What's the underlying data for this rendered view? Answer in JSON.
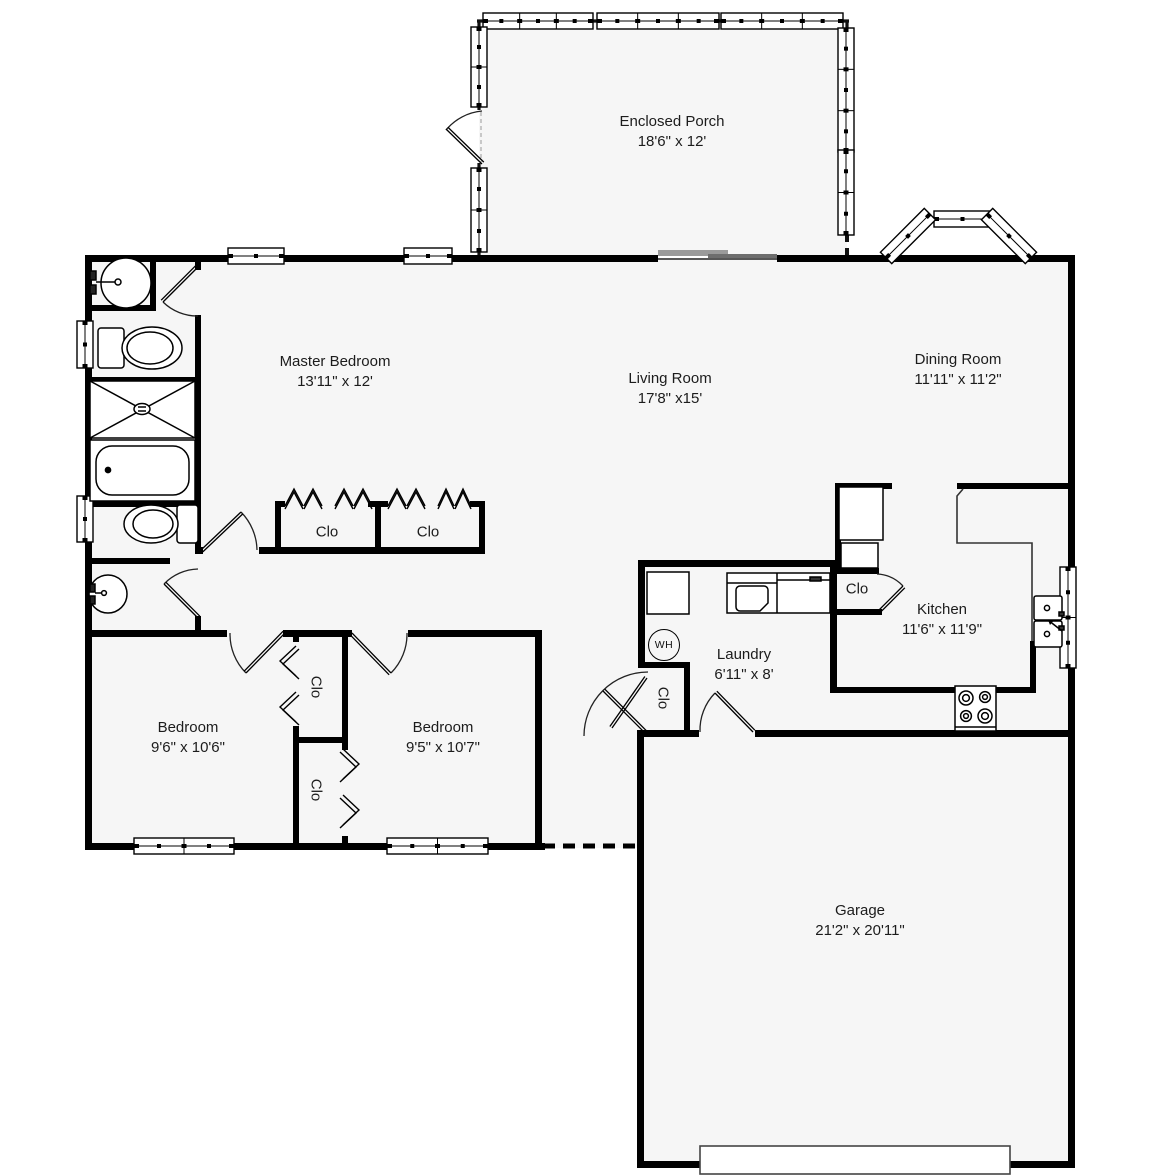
{
  "title": "Floor Plan",
  "rooms": [
    {
      "name": "Enclosed Porch",
      "dims": "18'6\" x 12'"
    },
    {
      "name": "Master Bedroom",
      "dims": "13'11\" x 12'"
    },
    {
      "name": "Living Room",
      "dims": "17'8\" x15'"
    },
    {
      "name": "Dining Room",
      "dims": "11'11\" x 11'2\""
    },
    {
      "name": "Kitchen",
      "dims": "11'6\" x 11'9\""
    },
    {
      "name": "Laundry",
      "dims": "6'11\" x 8'"
    },
    {
      "name": "Bedroom",
      "dims": "9'6\" x 10'6\""
    },
    {
      "name": "Bedroom",
      "dims": "9'5\" x 10'7\""
    },
    {
      "name": "Garage",
      "dims": "21'2\" x 20'11\""
    }
  ],
  "closets": [
    {
      "label": "Clo"
    },
    {
      "label": "Clo"
    },
    {
      "label": "Clo"
    },
    {
      "label": "Clo"
    },
    {
      "label": "Clo"
    },
    {
      "label": "Clo"
    }
  ],
  "water_heater": {
    "label": "WH"
  },
  "colors": {
    "wall": "#000000",
    "floor": "#f6f6f6",
    "background": "#ffffff",
    "line": "#1a1a1a"
  }
}
